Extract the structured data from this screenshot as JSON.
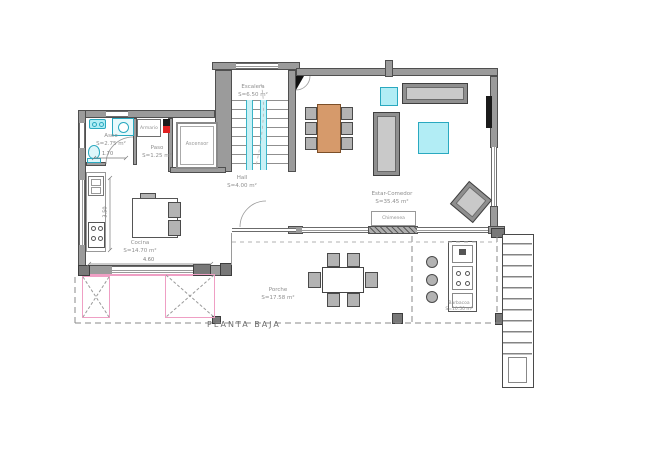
{
  "plan": {
    "title": "PLANTA BAJA",
    "rooms": {
      "escalera": {
        "name": "Escalera",
        "area": "S=6.50 m²"
      },
      "aseo": {
        "name": "Aseo",
        "area": "S=2.75 m²"
      },
      "paso": {
        "name": "Paso",
        "area": "S=1.25 m²"
      },
      "armario": {
        "name": "Armario"
      },
      "ascensor": {
        "name": "Ascensor"
      },
      "hall": {
        "name": "Hall",
        "area": "S=4.00 m²"
      },
      "cocina": {
        "name": "Cocina",
        "area": "S=14.70 m²"
      },
      "estar_comedor": {
        "name": "Estar-Comedor",
        "area": "S=35.45 m²"
      },
      "chimenea": {
        "name": "Chimenea"
      },
      "porche": {
        "name": "Porche",
        "area": "S=17.58 m²"
      },
      "barbacoa": {
        "name": "Barbacoa",
        "area": "S=10.50 m²"
      }
    },
    "dimensions": {
      "aseo_width": "1.70",
      "cocina_width": "4.60",
      "cocina_depth": "3.50"
    },
    "colors": {
      "wall": "#9b9b9b",
      "wall_edge": "#4f4f4f",
      "cyan_fill": "#b2edf5",
      "cyan_stroke": "#2aa9c0",
      "pink_accent": "#ef9fc4",
      "wood": "#d69a6b",
      "red_marker": "#e02020"
    }
  }
}
